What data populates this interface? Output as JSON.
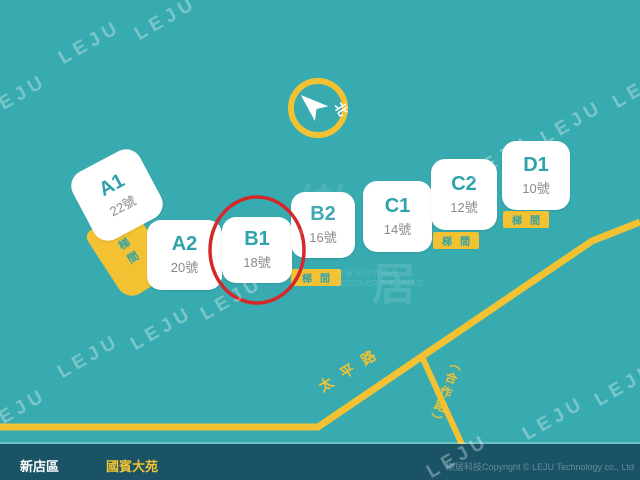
{
  "map": {
    "background_color": "#38ABB0",
    "road_color": "#F2C233",
    "highlight_color": "#D5282A",
    "building_text_color": "#2FA2AB"
  },
  "compass": {
    "label": "北"
  },
  "buildings": [
    {
      "label": "A1",
      "number": "22號"
    },
    {
      "label": "A2",
      "number": "20號"
    },
    {
      "label": "B1",
      "number": "18號",
      "highlighted": true
    },
    {
      "label": "B2",
      "number": "16號"
    },
    {
      "label": "C1",
      "number": "14號"
    },
    {
      "label": "C2",
      "number": "12號"
    },
    {
      "label": "D1",
      "number": "10號"
    }
  ],
  "stairs": {
    "label": "梯間"
  },
  "roads": [
    {
      "name": "太平路"
    },
    {
      "name": "（合作路）"
    }
  ],
  "watermark": {
    "text": "LEJU",
    "logo_char_1": "樂",
    "logo_char_2": "居",
    "tagline_zh": "發現居住的價值",
    "tagline_en": "DISCOVER THE VALUE"
  },
  "footer": {
    "district": "新店區",
    "community": "國賓大苑",
    "copyright": "樂居科技Copyright © LEJU Technology co., Ltd"
  }
}
